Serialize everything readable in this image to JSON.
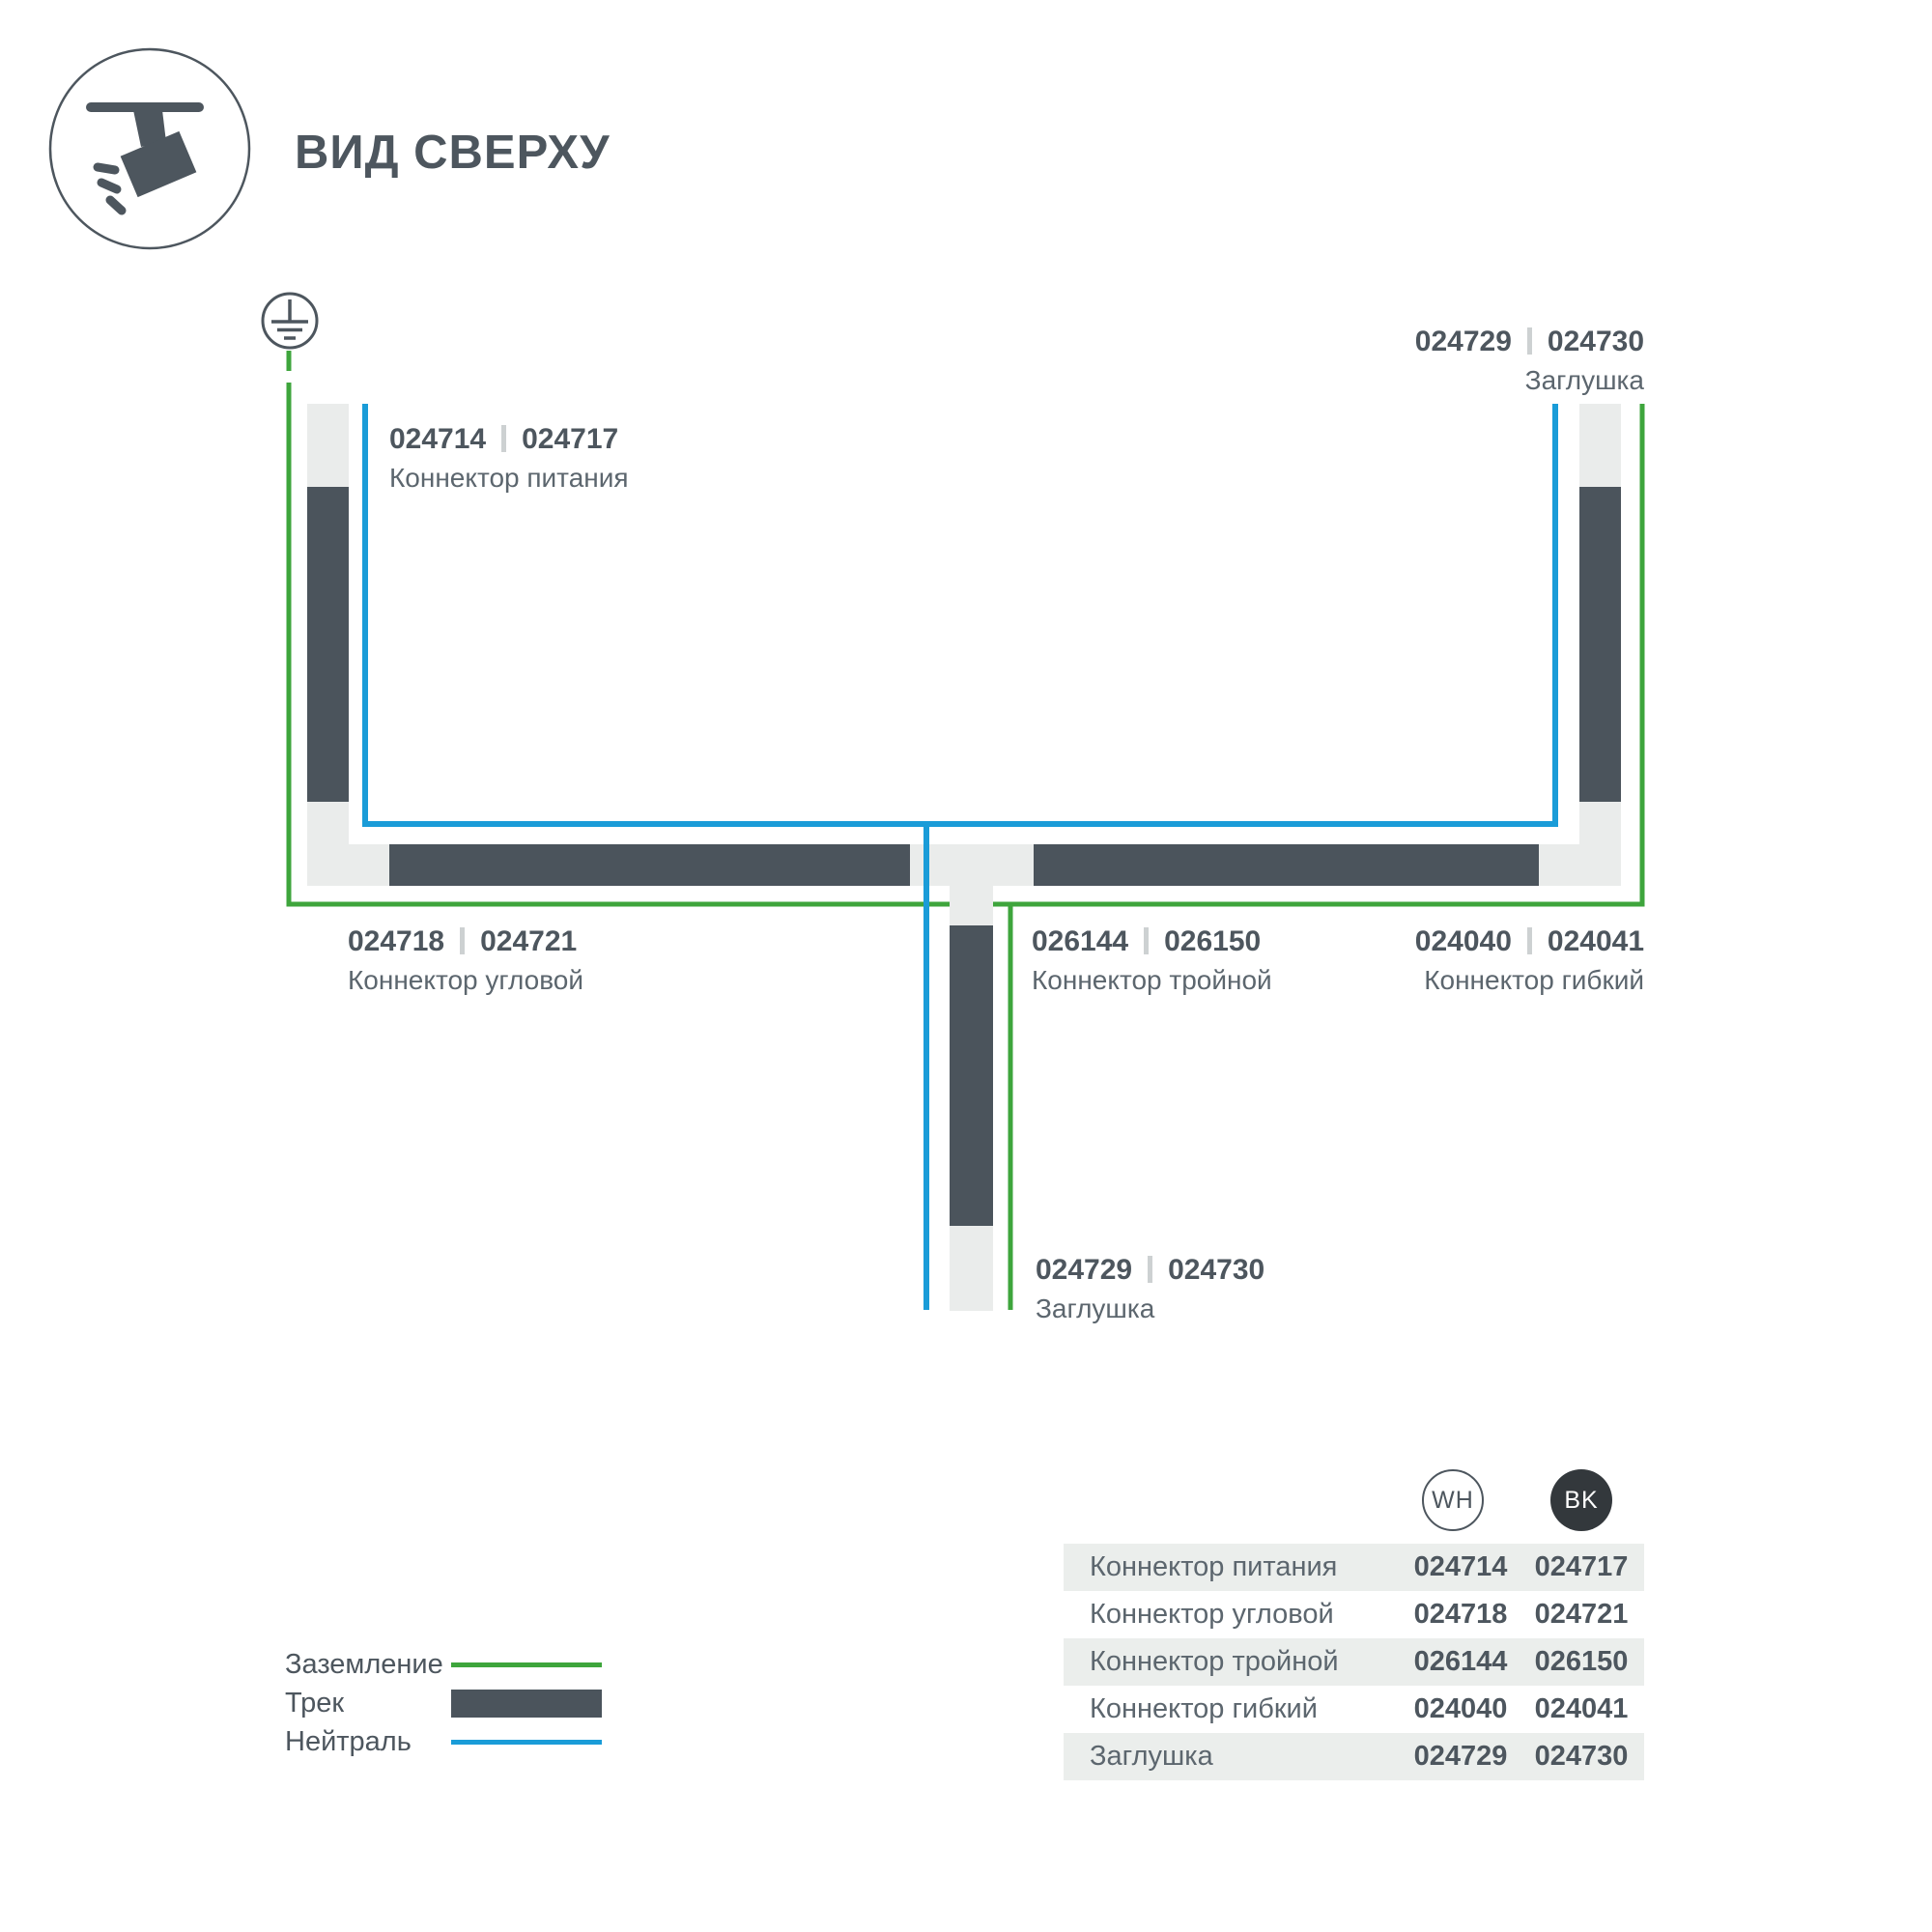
{
  "header": {
    "title": "ВИД СВЕРХУ"
  },
  "colors": {
    "track": "#4b545c",
    "connector": "#eaeceb",
    "ground_green": "#3ea53c",
    "neutral_blue": "#1a9cd8",
    "text_dark": "#4d565e",
    "text_secondary": "#5c666e",
    "row_bg": "#ebeeec",
    "bk_badge": "#33383c",
    "separator": "#cdd1d2"
  },
  "diagram": {
    "labels": {
      "power": {
        "wh": "024714",
        "bk": "024717",
        "name": "Коннектор питания"
      },
      "corner": {
        "wh": "024718",
        "bk": "024721",
        "name": "Коннектор угловой"
      },
      "triple": {
        "wh": "026144",
        "bk": "026150",
        "name": "Коннектор тройной"
      },
      "flexible": {
        "wh": "024040",
        "bk": "024041",
        "name": "Коннектор гибкий"
      },
      "endcap_top": {
        "wh": "024729",
        "bk": "024730",
        "name": "Заглушка"
      },
      "endcap_bottom": {
        "wh": "024729",
        "bk": "024730",
        "name": "Заглушка"
      }
    }
  },
  "legend": {
    "items": [
      {
        "label": "Заземление",
        "swatch": "green-line"
      },
      {
        "label": "Трек",
        "swatch": "track-bar"
      },
      {
        "label": "Нейтраль",
        "swatch": "blue-line"
      }
    ]
  },
  "table": {
    "columns": [
      {
        "code": "WH"
      },
      {
        "code": "BK"
      }
    ],
    "rows": [
      {
        "name": "Коннектор питания",
        "wh": "024714",
        "bk": "024717"
      },
      {
        "name": "Коннектор угловой",
        "wh": "024718",
        "bk": "024721"
      },
      {
        "name": "Коннектор тройной",
        "wh": "026144",
        "bk": "026150"
      },
      {
        "name": "Коннектор гибкий",
        "wh": "024040",
        "bk": "024041"
      },
      {
        "name": "Заглушка",
        "wh": "024729",
        "bk": "024730"
      }
    ]
  }
}
